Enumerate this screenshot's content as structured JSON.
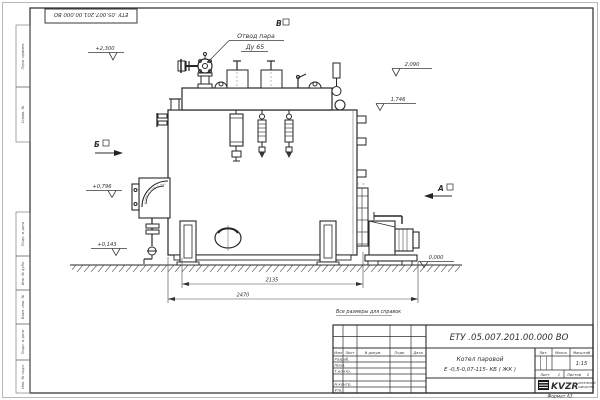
{
  "frame": {
    "top_stamp": "ЕТУ .05.007.201.00.000 ВО",
    "format_note": "Формат А3",
    "margin_labels": [
      "Перв. примен.",
      "Справ. №",
      "Подп. и дата",
      "Инв. № дубл.",
      "Взам. инв. №",
      "Подп. и дата",
      "Инв. № подл."
    ]
  },
  "drawing": {
    "reference_note": "Все размеры для справок",
    "callout_line1": "Отвод пара",
    "callout_line2": "Ду 65",
    "view_a": "А",
    "view_b": "Б",
    "view_v": "В",
    "dim_width_upper": "2135",
    "dim_width_lower": "2470",
    "elev_drum_top": "+2,300",
    "elev_2090": "2,090",
    "elev_1746": "1,746",
    "elev_0796": "+0,796",
    "elev_0143": "+0,143",
    "elev_zero": "0,000"
  },
  "title_block": {
    "doc_number": "ЕТУ .05.007.201.00.000 ВО",
    "product_name_line1": "Котел паровой",
    "product_name_line2": "Е -0,5-0,07-115- КБ ( ЖК )",
    "col_izm": "Изм",
    "col_list": "Лист",
    "col_ndoc": "N докум.",
    "col_podp": "Подп.",
    "col_data": "Дата",
    "row_razrab": "Разраб.",
    "row_prov": "Пров.",
    "row_tkontr": "Т.контр.",
    "row_nkontr": "Н.контр.",
    "row_utv": "Утв.",
    "lit_label": "Лит.",
    "mass_label": "Масса",
    "scale_label": "Масштаб",
    "scale_value": "1:15",
    "sheet_label": "Лист",
    "sheet_value": "1",
    "sheets_label": "Листов",
    "sheets_value": "2",
    "logo_text": "KVZR",
    "logo_sub_line1": "КОТЕЛЬНЫЙ",
    "logo_sub_line2": "ЗАВОД РЭП"
  }
}
